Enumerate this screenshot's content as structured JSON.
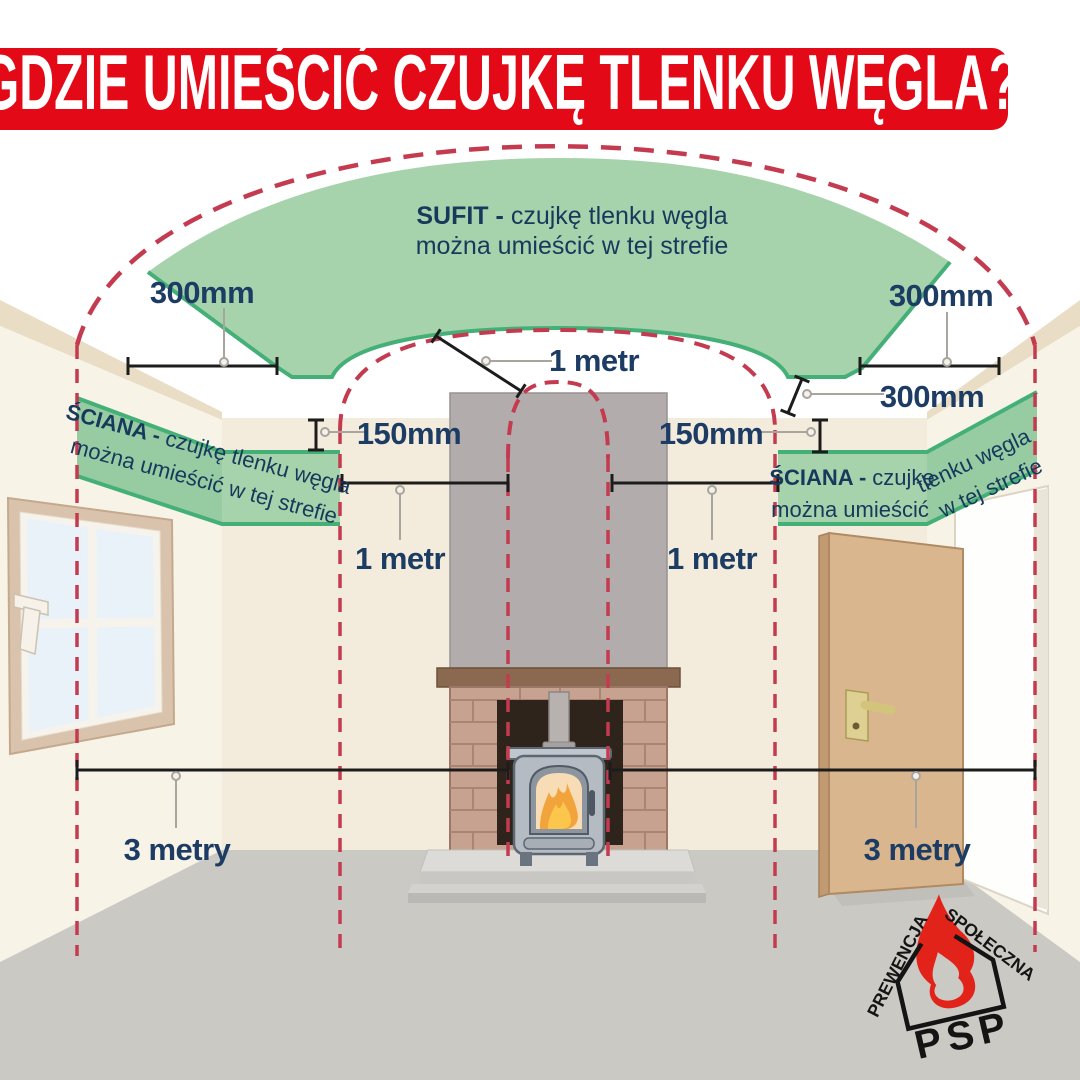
{
  "title": "GDZIE UMIEŚCIĆ CZUJKĘ TLENKU WĘGLA?",
  "zones": {
    "ceiling": {
      "label_bold": "SUFIT -",
      "label_line1": "czujkę tlenku węgla",
      "label_line2": "można umieścić w tej strefie"
    },
    "wall_left": {
      "label_bold": "ŚCIANA -",
      "label_line1": "czujkę tlenku węgla",
      "label_line2": "można umieścić w tej strefie"
    },
    "wall_right": {
      "label_bold": "ŚCIANA -",
      "label_line1": "czujkę",
      "label_line2": "można umieścić",
      "label_line1_wall": "tlenku węgla",
      "label_line2_wall": "w tej strefie"
    }
  },
  "measurements": {
    "ceiling_left": "300mm",
    "ceiling_right": "300mm",
    "ceiling_right_corner": "300mm",
    "wall_left_gap": "150mm",
    "wall_right_gap": "150mm",
    "flue_top": "1 metr",
    "flue_left": "1 metr",
    "flue_right": "1 metr",
    "floor_left": "3 metry",
    "floor_right": "3 metry"
  },
  "logo": {
    "top_text": "PREWENCJA",
    "right_text": "SPOŁECZNA",
    "name": "PSP"
  },
  "colors": {
    "banner_red": "#e30917",
    "zone_green": "#a6d3ab",
    "zone_edge_green": "#44b078",
    "dashed_red": "#c43b50",
    "label_navy": "#1d3c63",
    "flame_red": "#e2231a"
  }
}
